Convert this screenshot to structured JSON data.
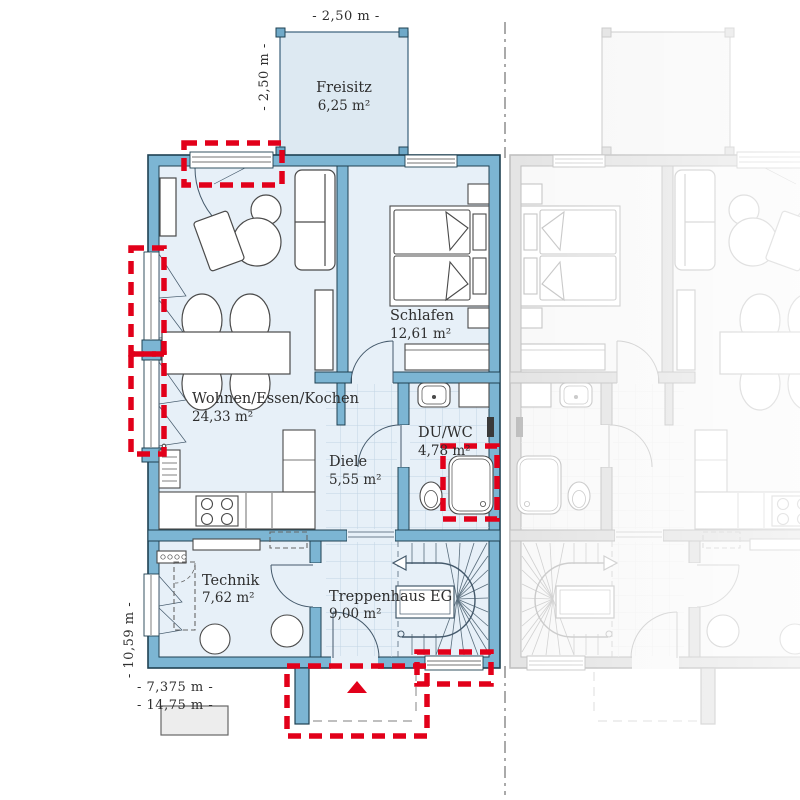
{
  "plan": {
    "type": "floor-plan",
    "floor": "EG",
    "rooms": {
      "freisitz": {
        "name": "Freisitz",
        "area": "6,25 m²"
      },
      "wohnen": {
        "name": "Wohnen/Essen/Kochen",
        "area": "24,33 m²"
      },
      "schlafen": {
        "name": "Schlafen",
        "area": "12,61 m²"
      },
      "diele": {
        "name": "Diele",
        "area": "5,55 m²"
      },
      "duwc": {
        "name": "DU/WC",
        "area": "4,78 m²"
      },
      "technik": {
        "name": "Technik",
        "area": "7,62 m²"
      },
      "treppenhaus": {
        "name": "Treppenhaus EG",
        "area": "9,00 m²"
      }
    },
    "dimensions": {
      "terrace_width": "- 2,50 m -",
      "terrace_depth": "- 2,50 m -",
      "house_depth": "- 10,59 m -",
      "unit_width": "- 7,375 m -",
      "total_width": "- 14,75 m -"
    },
    "highlights": [
      "terrace-door",
      "living-window-upper",
      "living-window-lower",
      "shower",
      "stair-window",
      "entrance-porch"
    ],
    "colors": {
      "wall": "#7cb5d3",
      "room_fill": "#e7f0f8",
      "terrace_fill": "#dde9f2",
      "outline": "#1f4152",
      "tile_line": "#c2d4e3",
      "highlight_red": "#e2001a",
      "furniture_stroke": "#4a4a4a",
      "faded_unit": "#9a9a9a"
    }
  }
}
